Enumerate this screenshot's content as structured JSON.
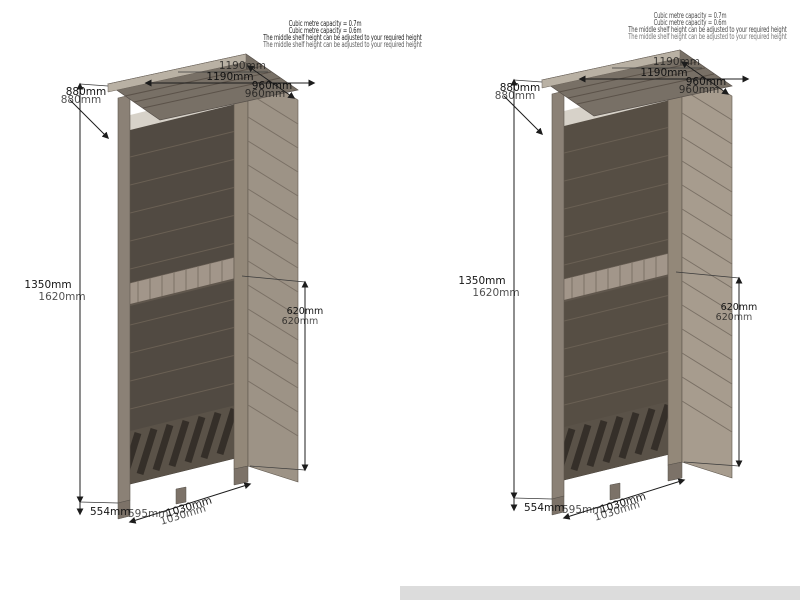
{
  "captions": {
    "capacity_a": "Cubic metre capacity = 0.7m",
    "capacity_b": "Cubic metre capacity = 0.6m",
    "shelf_note": "The middle shelf height can be adjusted to your required height"
  },
  "dimensions": {
    "top_width": "1190mm",
    "roof_back_height": "880mm",
    "roof_side_depth": "960mm",
    "overall_height": "1350mm",
    "overall_height_alt": "1620mm",
    "shelf_height": "620mm",
    "base_depth": "554mm",
    "base_depth_alt": "595mm",
    "base_width": "1030mm"
  },
  "colors": {
    "background": "#ffffff",
    "dimension_ink": "#141414",
    "wood_interior": "#514a42",
    "wood_roof": "#787066",
    "wood_fascia": "#b9b1a4",
    "wood_post": "#8b8176",
    "wood_side_panel": "#9d9386",
    "wood_shelf": "#a2968a",
    "footer_bar": "#dcdcdc"
  }
}
